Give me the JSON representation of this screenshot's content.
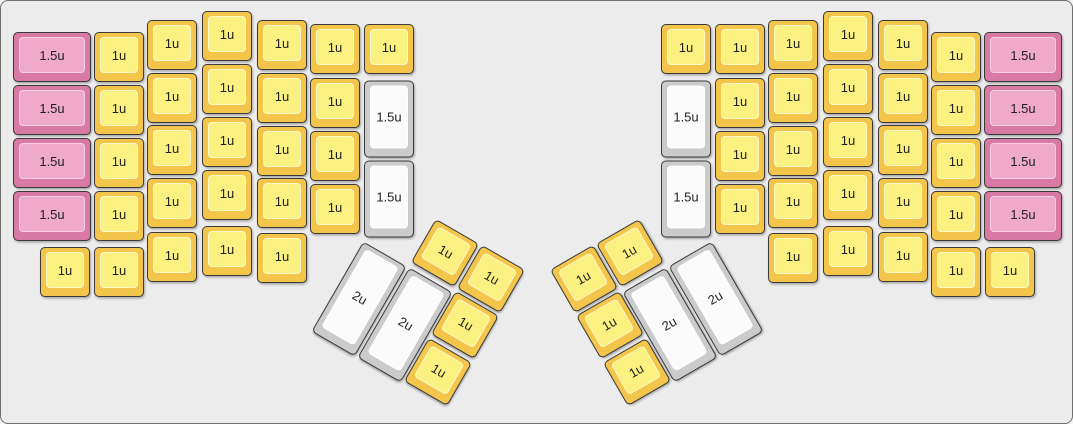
{
  "canvas": {
    "width": 1073,
    "height": 424,
    "background": "#ececec",
    "border_color": "#6e6e6e",
    "outline_color": "#3a3a3a"
  },
  "key_colors": {
    "yellow": {
      "side": "#F3C64B",
      "top": "#FBF180",
      "top_border": "rgba(255,255,255,0.55)"
    },
    "pink": {
      "side": "#D97AA5",
      "top": "#EFA9C9",
      "top_border": "rgba(255,255,255,0.45)"
    },
    "white": {
      "side": "#CBCBCB",
      "top": "#FBFBFB",
      "top_border": "rgba(255,255,255,0.9)"
    }
  },
  "keys": [
    {
      "label": "1.5u",
      "color": "pink",
      "cx": 51,
      "cy": 56,
      "w": 78,
      "h": 50,
      "rot": 0
    },
    {
      "label": "1.5u",
      "color": "pink",
      "cx": 51,
      "cy": 109,
      "w": 78,
      "h": 50,
      "rot": 0
    },
    {
      "label": "1.5u",
      "color": "pink",
      "cx": 51,
      "cy": 162,
      "w": 78,
      "h": 50,
      "rot": 0
    },
    {
      "label": "1.5u",
      "color": "pink",
      "cx": 51,
      "cy": 215,
      "w": 78,
      "h": 50,
      "rot": 0
    },
    {
      "label": "1u",
      "color": "yellow",
      "cx": 118,
      "cy": 56,
      "w": 50,
      "h": 50,
      "rot": 0
    },
    {
      "label": "1u",
      "color": "yellow",
      "cx": 118,
      "cy": 109,
      "w": 50,
      "h": 50,
      "rot": 0
    },
    {
      "label": "1u",
      "color": "yellow",
      "cx": 118,
      "cy": 162,
      "w": 50,
      "h": 50,
      "rot": 0
    },
    {
      "label": "1u",
      "color": "yellow",
      "cx": 118,
      "cy": 215,
      "w": 50,
      "h": 50,
      "rot": 0
    },
    {
      "label": "1u",
      "color": "yellow",
      "cx": 64,
      "cy": 271,
      "w": 50,
      "h": 50,
      "rot": 0
    },
    {
      "label": "1u",
      "color": "yellow",
      "cx": 118,
      "cy": 271,
      "w": 50,
      "h": 50,
      "rot": 0
    },
    {
      "label": "1u",
      "color": "yellow",
      "cx": 171,
      "cy": 44,
      "w": 50,
      "h": 50,
      "rot": 0
    },
    {
      "label": "1u",
      "color": "yellow",
      "cx": 171,
      "cy": 97,
      "w": 50,
      "h": 50,
      "rot": 0
    },
    {
      "label": "1u",
      "color": "yellow",
      "cx": 171,
      "cy": 149,
      "w": 50,
      "h": 50,
      "rot": 0
    },
    {
      "label": "1u",
      "color": "yellow",
      "cx": 171,
      "cy": 202,
      "w": 50,
      "h": 50,
      "rot": 0
    },
    {
      "label": "1u",
      "color": "yellow",
      "cx": 171,
      "cy": 256,
      "w": 50,
      "h": 50,
      "rot": 0
    },
    {
      "label": "1u",
      "color": "yellow",
      "cx": 226,
      "cy": 35,
      "w": 50,
      "h": 50,
      "rot": 0
    },
    {
      "label": "1u",
      "color": "yellow",
      "cx": 226,
      "cy": 88,
      "w": 50,
      "h": 50,
      "rot": 0
    },
    {
      "label": "1u",
      "color": "yellow",
      "cx": 226,
      "cy": 141,
      "w": 50,
      "h": 50,
      "rot": 0
    },
    {
      "label": "1u",
      "color": "yellow",
      "cx": 226,
      "cy": 194,
      "w": 50,
      "h": 50,
      "rot": 0
    },
    {
      "label": "1u",
      "color": "yellow",
      "cx": 226,
      "cy": 250,
      "w": 50,
      "h": 50,
      "rot": 0
    },
    {
      "label": "1u",
      "color": "yellow",
      "cx": 281,
      "cy": 44,
      "w": 50,
      "h": 50,
      "rot": 0
    },
    {
      "label": "1u",
      "color": "yellow",
      "cx": 281,
      "cy": 97,
      "w": 50,
      "h": 50,
      "rot": 0
    },
    {
      "label": "1u",
      "color": "yellow",
      "cx": 281,
      "cy": 150,
      "w": 50,
      "h": 50,
      "rot": 0
    },
    {
      "label": "1u",
      "color": "yellow",
      "cx": 281,
      "cy": 202,
      "w": 50,
      "h": 50,
      "rot": 0
    },
    {
      "label": "1u",
      "color": "yellow",
      "cx": 281,
      "cy": 257,
      "w": 50,
      "h": 50,
      "rot": 0
    },
    {
      "label": "1u",
      "color": "yellow",
      "cx": 334,
      "cy": 48,
      "w": 50,
      "h": 50,
      "rot": 0
    },
    {
      "label": "1u",
      "color": "yellow",
      "cx": 334,
      "cy": 102,
      "w": 50,
      "h": 50,
      "rot": 0
    },
    {
      "label": "1u",
      "color": "yellow",
      "cx": 334,
      "cy": 155,
      "w": 50,
      "h": 50,
      "rot": 0
    },
    {
      "label": "1u",
      "color": "yellow",
      "cx": 334,
      "cy": 208,
      "w": 50,
      "h": 50,
      "rot": 0
    },
    {
      "label": "1u",
      "color": "yellow",
      "cx": 388,
      "cy": 48,
      "w": 50,
      "h": 50,
      "rot": 0
    },
    {
      "label": "1.5u",
      "color": "white",
      "cx": 388,
      "cy": 118,
      "w": 50,
      "h": 77,
      "rot": 0
    },
    {
      "label": "1.5u",
      "color": "white",
      "cx": 388,
      "cy": 198,
      "w": 50,
      "h": 77,
      "rot": 0
    },
    {
      "label": "1u",
      "color": "yellow",
      "cx": 444,
      "cy": 252,
      "w": 50,
      "h": 50,
      "rot": 30
    },
    {
      "label": "1u",
      "color": "yellow",
      "cx": 490,
      "cy": 278,
      "w": 50,
      "h": 50,
      "rot": 30
    },
    {
      "label": "2u",
      "color": "white",
      "cx": 358,
      "cy": 298,
      "w": 50,
      "h": 104,
      "rot": 30
    },
    {
      "label": "2u",
      "color": "white",
      "cx": 404,
      "cy": 324,
      "w": 50,
      "h": 104,
      "rot": 30
    },
    {
      "label": "1u",
      "color": "yellow",
      "cx": 464,
      "cy": 324,
      "w": 50,
      "h": 50,
      "rot": 30
    },
    {
      "label": "1u",
      "color": "yellow",
      "cx": 437,
      "cy": 371,
      "w": 50,
      "h": 50,
      "rot": 30
    },
    {
      "label": "1u",
      "color": "yellow",
      "cx": 629,
      "cy": 252,
      "w": 50,
      "h": 50,
      "rot": -30
    },
    {
      "label": "1u",
      "color": "yellow",
      "cx": 583,
      "cy": 278,
      "w": 50,
      "h": 50,
      "rot": -30
    },
    {
      "label": "2u",
      "color": "white",
      "cx": 715,
      "cy": 298,
      "w": 50,
      "h": 104,
      "rot": -30
    },
    {
      "label": "2u",
      "color": "white",
      "cx": 669,
      "cy": 324,
      "w": 50,
      "h": 104,
      "rot": -30
    },
    {
      "label": "1u",
      "color": "yellow",
      "cx": 609,
      "cy": 324,
      "w": 50,
      "h": 50,
      "rot": -30
    },
    {
      "label": "1u",
      "color": "yellow",
      "cx": 636,
      "cy": 371,
      "w": 50,
      "h": 50,
      "rot": -30
    },
    {
      "label": "1u",
      "color": "yellow",
      "cx": 685,
      "cy": 48,
      "w": 50,
      "h": 50,
      "rot": 0
    },
    {
      "label": "1.5u",
      "color": "white",
      "cx": 685,
      "cy": 118,
      "w": 50,
      "h": 77,
      "rot": 0
    },
    {
      "label": "1.5u",
      "color": "white",
      "cx": 685,
      "cy": 198,
      "w": 50,
      "h": 77,
      "rot": 0
    },
    {
      "label": "1u",
      "color": "yellow",
      "cx": 739,
      "cy": 48,
      "w": 50,
      "h": 50,
      "rot": 0
    },
    {
      "label": "1u",
      "color": "yellow",
      "cx": 739,
      "cy": 102,
      "w": 50,
      "h": 50,
      "rot": 0
    },
    {
      "label": "1u",
      "color": "yellow",
      "cx": 739,
      "cy": 155,
      "w": 50,
      "h": 50,
      "rot": 0
    },
    {
      "label": "1u",
      "color": "yellow",
      "cx": 739,
      "cy": 208,
      "w": 50,
      "h": 50,
      "rot": 0
    },
    {
      "label": "1u",
      "color": "yellow",
      "cx": 792,
      "cy": 44,
      "w": 50,
      "h": 50,
      "rot": 0
    },
    {
      "label": "1u",
      "color": "yellow",
      "cx": 792,
      "cy": 97,
      "w": 50,
      "h": 50,
      "rot": 0
    },
    {
      "label": "1u",
      "color": "yellow",
      "cx": 792,
      "cy": 150,
      "w": 50,
      "h": 50,
      "rot": 0
    },
    {
      "label": "1u",
      "color": "yellow",
      "cx": 792,
      "cy": 202,
      "w": 50,
      "h": 50,
      "rot": 0
    },
    {
      "label": "1u",
      "color": "yellow",
      "cx": 792,
      "cy": 257,
      "w": 50,
      "h": 50,
      "rot": 0
    },
    {
      "label": "1u",
      "color": "yellow",
      "cx": 847,
      "cy": 35,
      "w": 50,
      "h": 50,
      "rot": 0
    },
    {
      "label": "1u",
      "color": "yellow",
      "cx": 847,
      "cy": 88,
      "w": 50,
      "h": 50,
      "rot": 0
    },
    {
      "label": "1u",
      "color": "yellow",
      "cx": 847,
      "cy": 141,
      "w": 50,
      "h": 50,
      "rot": 0
    },
    {
      "label": "1u",
      "color": "yellow",
      "cx": 847,
      "cy": 194,
      "w": 50,
      "h": 50,
      "rot": 0
    },
    {
      "label": "1u",
      "color": "yellow",
      "cx": 847,
      "cy": 250,
      "w": 50,
      "h": 50,
      "rot": 0
    },
    {
      "label": "1u",
      "color": "yellow",
      "cx": 902,
      "cy": 44,
      "w": 50,
      "h": 50,
      "rot": 0
    },
    {
      "label": "1u",
      "color": "yellow",
      "cx": 902,
      "cy": 97,
      "w": 50,
      "h": 50,
      "rot": 0
    },
    {
      "label": "1u",
      "color": "yellow",
      "cx": 902,
      "cy": 149,
      "w": 50,
      "h": 50,
      "rot": 0
    },
    {
      "label": "1u",
      "color": "yellow",
      "cx": 902,
      "cy": 202,
      "w": 50,
      "h": 50,
      "rot": 0
    },
    {
      "label": "1u",
      "color": "yellow",
      "cx": 902,
      "cy": 256,
      "w": 50,
      "h": 50,
      "rot": 0
    },
    {
      "label": "1u",
      "color": "yellow",
      "cx": 955,
      "cy": 56,
      "w": 50,
      "h": 50,
      "rot": 0
    },
    {
      "label": "1u",
      "color": "yellow",
      "cx": 955,
      "cy": 109,
      "w": 50,
      "h": 50,
      "rot": 0
    },
    {
      "label": "1u",
      "color": "yellow",
      "cx": 955,
      "cy": 162,
      "w": 50,
      "h": 50,
      "rot": 0
    },
    {
      "label": "1u",
      "color": "yellow",
      "cx": 955,
      "cy": 215,
      "w": 50,
      "h": 50,
      "rot": 0
    },
    {
      "label": "1u",
      "color": "yellow",
      "cx": 955,
      "cy": 271,
      "w": 50,
      "h": 50,
      "rot": 0
    },
    {
      "label": "1u",
      "color": "yellow",
      "cx": 1009,
      "cy": 271,
      "w": 50,
      "h": 50,
      "rot": 0
    },
    {
      "label": "1.5u",
      "color": "pink",
      "cx": 1022,
      "cy": 56,
      "w": 78,
      "h": 50,
      "rot": 0
    },
    {
      "label": "1.5u",
      "color": "pink",
      "cx": 1022,
      "cy": 109,
      "w": 78,
      "h": 50,
      "rot": 0
    },
    {
      "label": "1.5u",
      "color": "pink",
      "cx": 1022,
      "cy": 162,
      "w": 78,
      "h": 50,
      "rot": 0
    },
    {
      "label": "1.5u",
      "color": "pink",
      "cx": 1022,
      "cy": 215,
      "w": 78,
      "h": 50,
      "rot": 0
    }
  ]
}
